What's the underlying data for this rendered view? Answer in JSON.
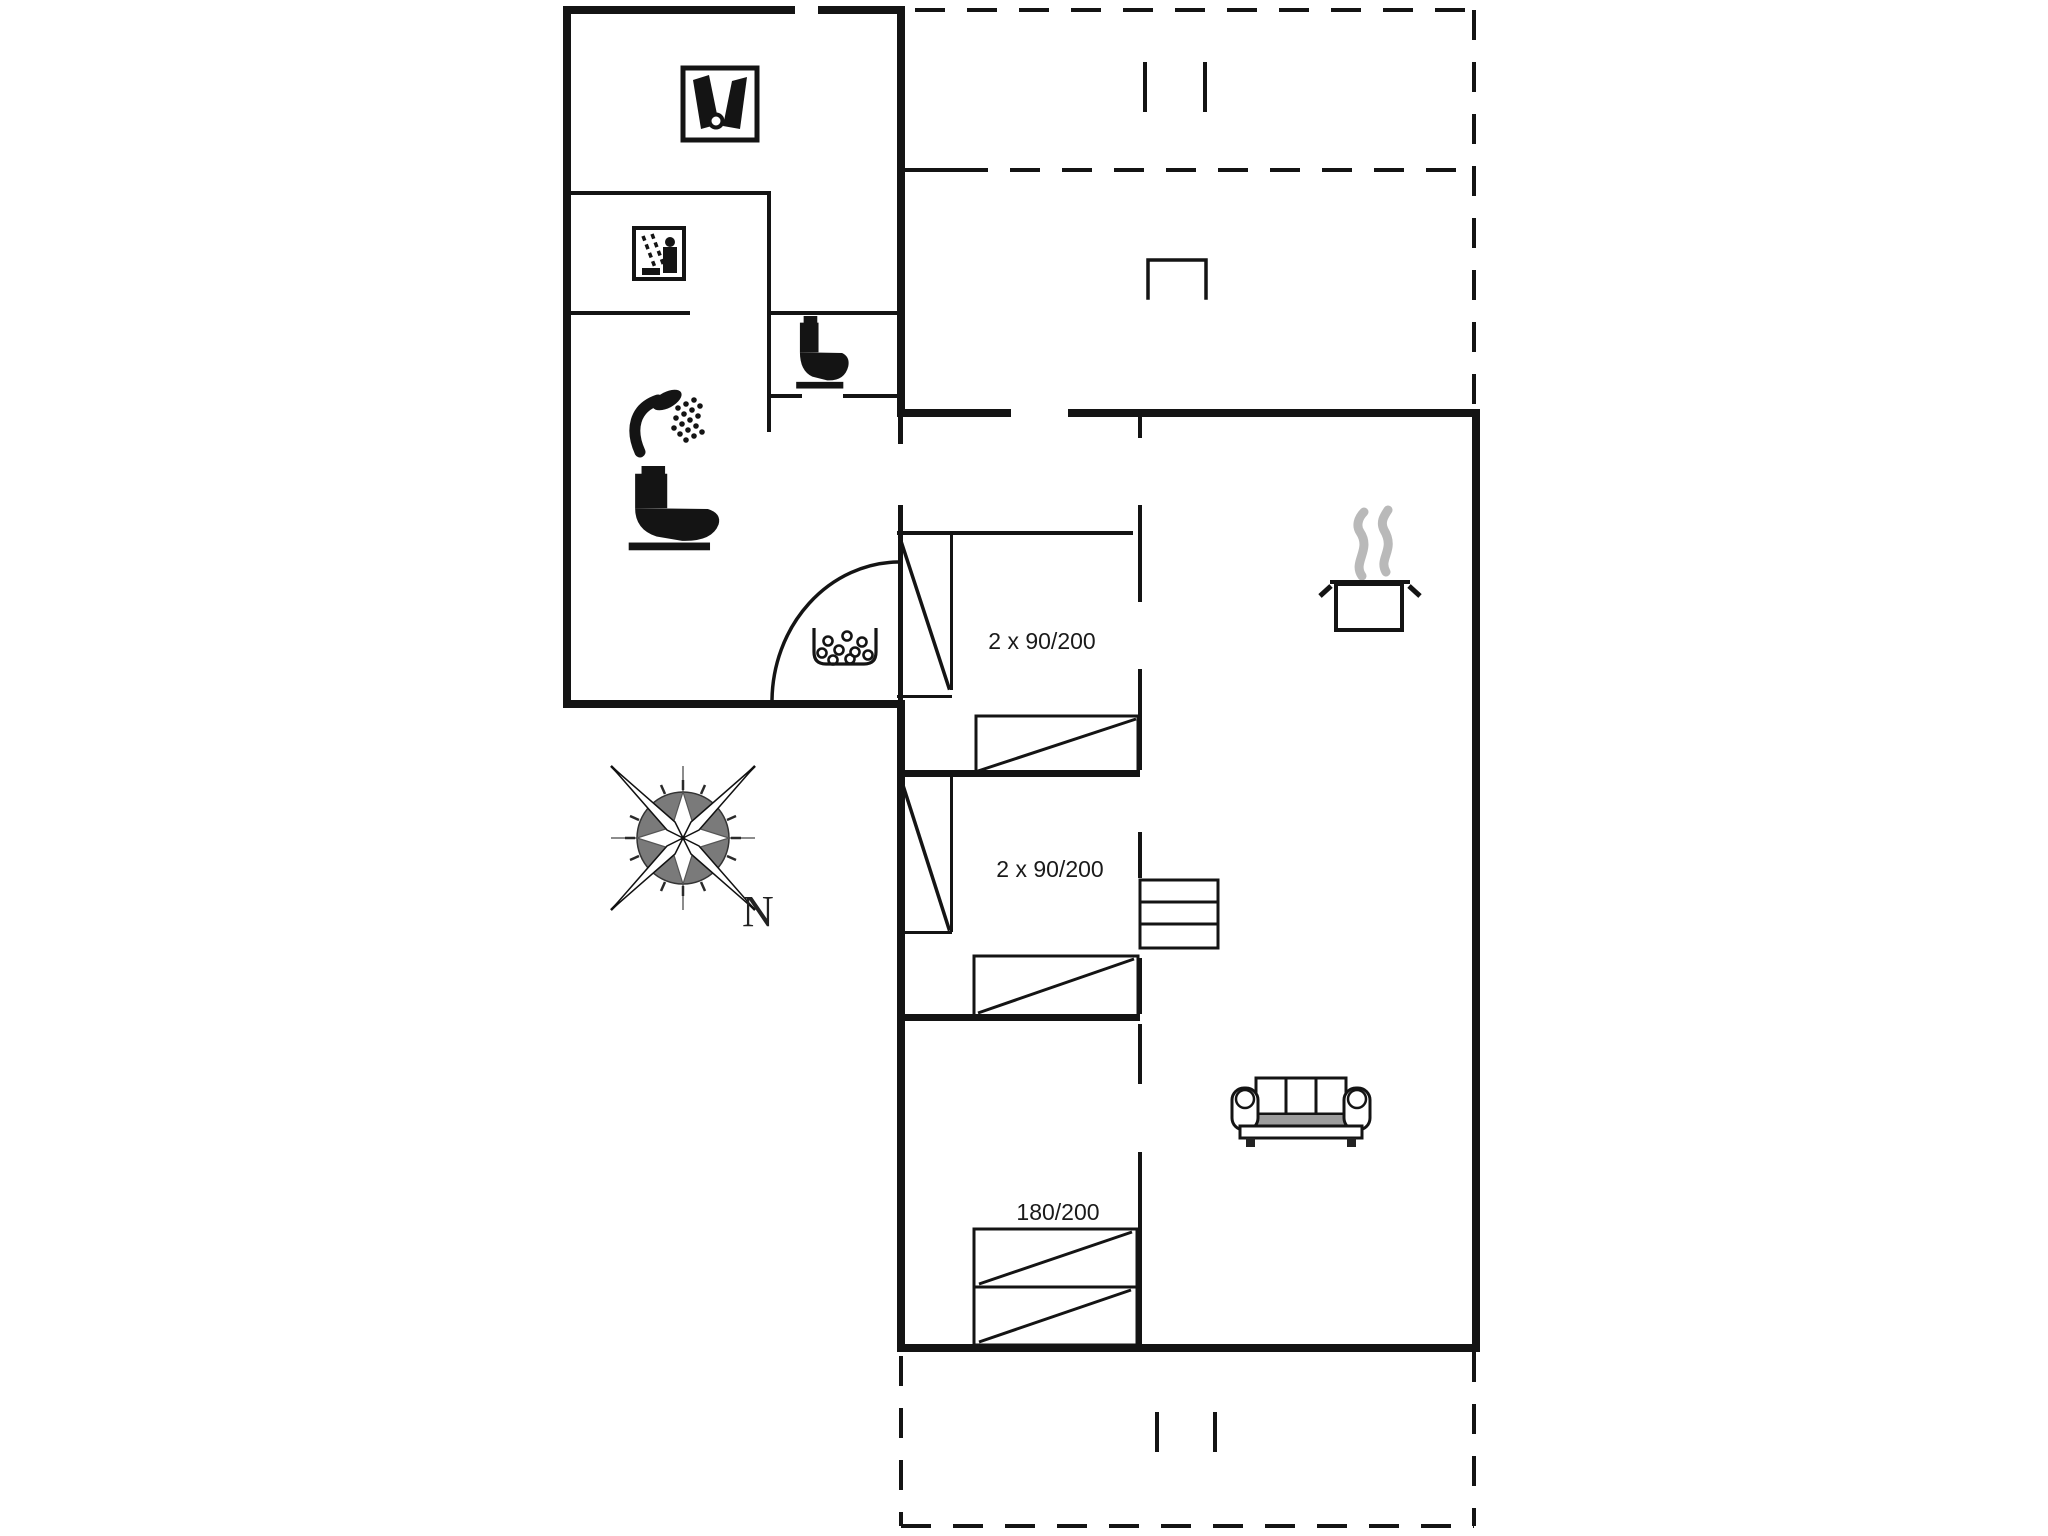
{
  "plan": {
    "type": "floor-plan",
    "labels": {
      "bedroom1_bed": "2 x 90/200",
      "bedroom2_bed": "2 x 90/200",
      "bedroom3_bed": "180/200",
      "compass_north": "N"
    },
    "colors": {
      "wall": "#141414",
      "background": "#ffffff",
      "steam_grey": "#b9b9b9",
      "sofa_seat_grey": "#9c9c9c",
      "compass_disc_grey": "#7a7a7a"
    },
    "icons": [
      "washing-machine-icon",
      "sauna-icon",
      "toilet-icon",
      "shower-icon",
      "doormat-dots-icon",
      "cooking-pot-icon",
      "sofa-icon",
      "stairs-icon",
      "compass-rose-icon"
    ]
  }
}
